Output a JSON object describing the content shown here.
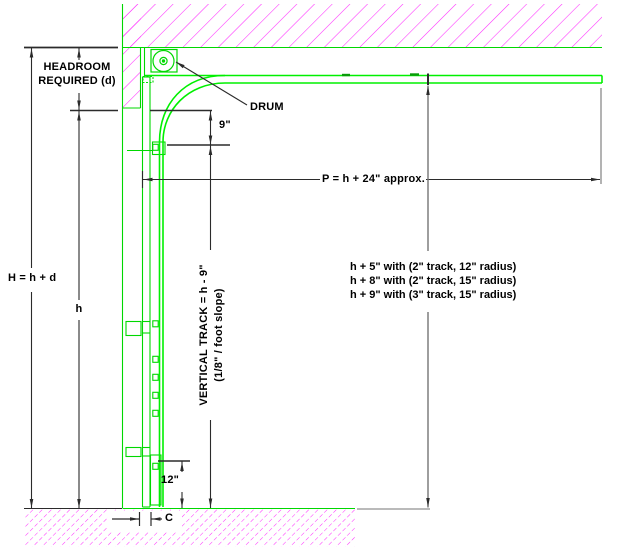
{
  "drawing": {
    "type": "garage-door-track-section-detail",
    "labels": {
      "headroom_line1": "HEADROOM",
      "headroom_line2": "REQUIRED (d)",
      "drum": "DRUM",
      "track_offset": "9\"",
      "projection": "P = h + 24\" approx.",
      "total_height": "H = h + d",
      "door_height": "h",
      "vertical_track_line1": "VERTICAL TRACK = h - 9\"",
      "vertical_track_line2": "(1/8\" / foot slope)",
      "bottom_dim": "12\"",
      "clearance": "C"
    },
    "notes": [
      "h + 5\" with (2\" track, 12\" radius)",
      "h + 8\" with (2\" track, 15\" radius)",
      "h + 9\" with (3\" track, 15\" radius)"
    ],
    "colors": {
      "hatch_magenta": "#ff2dff",
      "track_green": "#00f000",
      "structure_green": "#00d800",
      "dimension_dark": "#2b2b2b",
      "dimension_gray": "#757575"
    }
  }
}
